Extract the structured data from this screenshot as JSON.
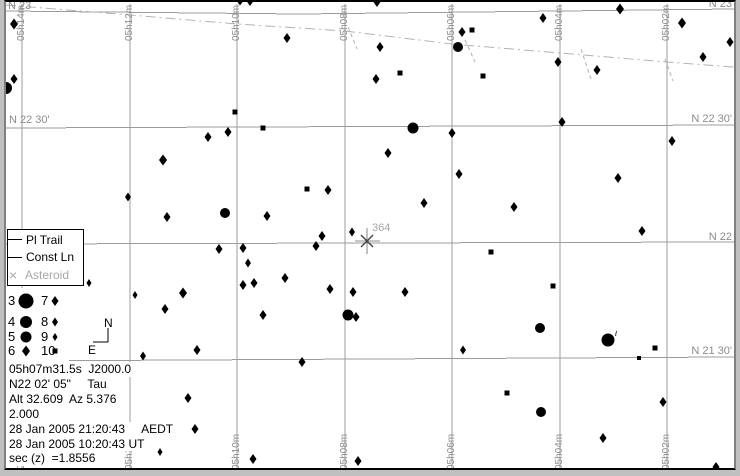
{
  "window": {
    "bg": "#c0c0c0",
    "chart_bg": "#ffffff"
  },
  "colors": {
    "grid": "#9c9c9c",
    "labels": "#8c8c8c",
    "ecliptic": "#b3b3b3",
    "star": "#000000",
    "asteroid": "#444444",
    "asteroid_label": "#a6a6a6",
    "legend_muted": "#a8a8a8"
  },
  "legend": {
    "items": [
      {
        "symbol": "line",
        "label": "Pl Trail",
        "muted": false
      },
      {
        "symbol": "line",
        "label": "Const Ln",
        "muted": false
      },
      {
        "symbol": "x",
        "label": "Asteroid",
        "muted": true
      }
    ]
  },
  "compass": {
    "corner": [
      108,
      342
    ],
    "arm_up": 14,
    "arm_left": 15,
    "north": {
      "label": "N",
      "x": 104,
      "y": 327
    },
    "east": {
      "label": "E",
      "x": 88,
      "y": 354
    }
  },
  "magnitude_legend": {
    "left_num_x": 8,
    "left_dot_x": 26,
    "right_num_x": 41,
    "right_dot_x": 55,
    "row_y": [
      301,
      322,
      337,
      351
    ],
    "rows": [
      {
        "left_label": "3",
        "left_d": 15,
        "right_label": "7",
        "right_d": 8
      },
      {
        "left_label": "4",
        "left_d": 12,
        "right_label": "8",
        "right_d": 7
      },
      {
        "left_label": "5",
        "left_d": 11,
        "right_label": "9",
        "right_d": 6
      },
      {
        "left_label": "6",
        "left_d": 9,
        "right_label": "10",
        "right_d": 5
      }
    ]
  },
  "info": {
    "lines": [
      "05h07m31.5s  J2000.0",
      "N22 02' 05\"     Tau",
      "Alt 32.609  Az 5.376",
      "2.000",
      "28 Jan 2005 21:20:43     AEDT",
      "28 Jan 2005 10:20:43 UT",
      "sec (z)  =1.8556"
    ]
  },
  "chart_data": {
    "type": "scatter",
    "title": "Star chart field centered 05h07m31.5s N22 02' 05\" (Taurus)",
    "ra_lines": [
      {
        "x": 22,
        "label": "05h14m"
      },
      {
        "x": 130,
        "label": "05h12m"
      },
      {
        "x": 237,
        "label": "05h10m"
      },
      {
        "x": 345,
        "label": "05h08m"
      },
      {
        "x": 452,
        "label": "05h06m"
      },
      {
        "x": 560,
        "label": "05h04m"
      },
      {
        "x": 667,
        "label": "05h02m"
      }
    ],
    "dec_lines": [
      {
        "label": "N 23",
        "pts": [
          [
            6,
            11
          ],
          [
            300,
            14
          ],
          [
            734,
            9
          ]
        ],
        "left": {
          "x": 8,
          "y": 9
        },
        "right": {
          "x": 732,
          "y": 7
        }
      },
      {
        "label": "N 22 30'",
        "pts": [
          [
            6,
            128
          ],
          [
            734,
            125
          ]
        ],
        "left": {
          "x": 9,
          "y": 123
        },
        "right": {
          "x": 732,
          "y": 122
        }
      },
      {
        "label": "N 22",
        "pts": [
          [
            6,
            244
          ],
          [
            734,
            242
          ]
        ],
        "left": null,
        "right": {
          "x": 732,
          "y": 240
        }
      },
      {
        "label": "N 21 30'",
        "pts": [
          [
            6,
            361
          ],
          [
            734,
            357
          ]
        ],
        "left": null,
        "right": {
          "x": 732,
          "y": 354
        }
      }
    ],
    "ecliptic": {
      "points": [
        [
          6,
          5
        ],
        [
          130,
          15
        ],
        [
          237,
          24
        ],
        [
          345,
          31
        ],
        [
          452,
          44
        ],
        [
          560,
          53
        ],
        [
          667,
          62
        ],
        [
          734,
          67
        ]
      ],
      "ticks": [
        [
          348,
          27,
          357,
          49
        ],
        [
          465,
          40,
          475,
          62
        ],
        [
          581,
          49,
          591,
          79
        ],
        [
          665,
          59,
          673,
          81
        ]
      ]
    },
    "stars": [
      [
        14,
        24,
        9
      ],
      [
        14,
        79,
        8
      ],
      [
        6,
        88,
        12
      ],
      [
        240,
        0,
        9
      ],
      [
        250,
        1,
        8
      ],
      [
        377,
        2,
        8
      ],
      [
        620,
        9,
        9
      ],
      [
        287,
        38,
        8
      ],
      [
        380,
        47,
        8
      ],
      [
        376,
        79,
        8
      ],
      [
        400,
        73,
        5
      ],
      [
        462,
        32,
        8
      ],
      [
        472,
        30,
        5
      ],
      [
        458,
        47,
        10
      ],
      [
        483,
        76,
        5
      ],
      [
        543,
        18,
        8
      ],
      [
        558,
        62,
        8
      ],
      [
        597,
        70,
        8
      ],
      [
        682,
        23,
        9
      ],
      [
        703,
        57,
        8
      ],
      [
        730,
        42,
        8
      ],
      [
        235,
        112,
        5
      ],
      [
        413,
        128,
        11
      ],
      [
        208,
        137,
        8
      ],
      [
        228,
        132,
        8
      ],
      [
        263,
        128,
        5
      ],
      [
        388,
        153,
        8
      ],
      [
        163,
        160,
        9
      ],
      [
        128,
        197,
        7
      ],
      [
        307,
        189,
        5
      ],
      [
        328,
        190,
        8
      ],
      [
        167,
        217,
        8
      ],
      [
        225,
        213,
        10
      ],
      [
        267,
        216,
        8
      ],
      [
        352,
        232,
        7
      ],
      [
        322,
        236,
        8
      ],
      [
        316,
        246,
        8
      ],
      [
        219,
        249,
        8
      ],
      [
        243,
        248,
        8
      ],
      [
        248,
        263,
        7
      ],
      [
        285,
        278,
        8
      ],
      [
        243,
        285,
        8
      ],
      [
        254,
        283,
        8
      ],
      [
        135,
        295,
        6
      ],
      [
        183,
        293,
        9
      ],
      [
        330,
        289,
        8
      ],
      [
        353,
        292,
        8
      ],
      [
        405,
        292,
        8
      ],
      [
        89,
        283,
        6
      ],
      [
        562,
        122,
        8
      ],
      [
        452,
        133,
        8
      ],
      [
        672,
        141,
        8
      ],
      [
        459,
        174,
        8
      ],
      [
        618,
        178,
        8
      ],
      [
        424,
        203,
        8
      ],
      [
        514,
        207,
        8
      ],
      [
        642,
        231,
        8
      ],
      [
        491,
        252,
        5
      ],
      [
        553,
        286,
        5
      ],
      [
        165,
        309,
        8
      ],
      [
        263,
        315,
        8
      ],
      [
        348,
        315,
        11
      ],
      [
        356,
        317,
        8
      ],
      [
        197,
        350,
        8
      ],
      [
        143,
        356,
        7
      ],
      [
        302,
        362,
        8
      ],
      [
        188,
        398,
        8
      ],
      [
        195,
        429,
        8
      ],
      [
        160,
        452,
        6
      ],
      [
        253,
        459,
        8
      ],
      [
        358,
        461,
        8
      ],
      [
        540,
        328,
        10
      ],
      [
        463,
        350,
        7
      ],
      [
        608,
        340,
        13
      ],
      [
        639,
        358,
        4
      ],
      [
        655,
        348,
        5
      ],
      [
        663,
        402,
        8
      ],
      [
        507,
        393,
        5
      ],
      [
        541,
        412,
        10
      ],
      [
        603,
        438,
        8
      ],
      [
        716,
        467,
        8
      ]
    ],
    "star_labels": [
      {
        "text": "ι",
        "x": 615,
        "y": 336
      }
    ],
    "asteroid": {
      "x": 367,
      "y": 241,
      "label": "364"
    }
  }
}
